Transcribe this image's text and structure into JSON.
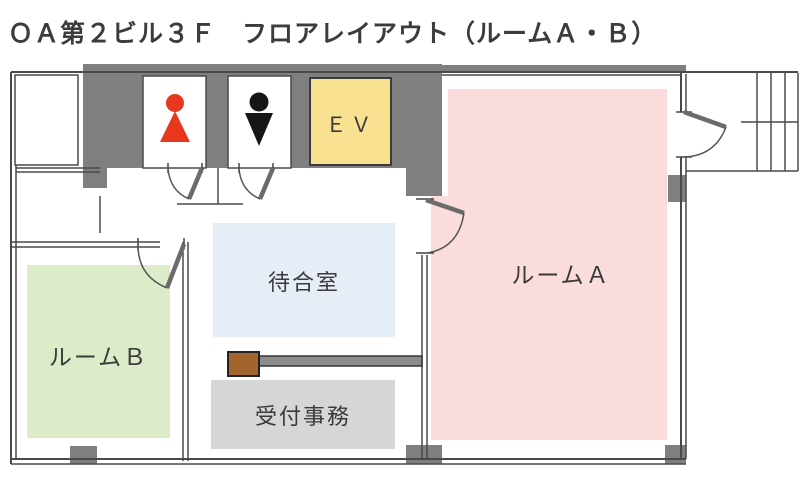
{
  "title": "ＯＡ第２ビル３Ｆ　フロアレイアウト（ルームＡ・Ｂ）",
  "rooms": {
    "room_a": {
      "label": "ルームＡ"
    },
    "room_b": {
      "label": "ルームＢ"
    },
    "waiting_room": {
      "label": "待合室"
    },
    "reception": {
      "label": "受付事務"
    },
    "elevator": {
      "label": "ＥＶ"
    }
  },
  "icons": {
    "female_restroom": "female-figure",
    "male_restroom": "male-figure"
  },
  "colors": {
    "wall_gray": "#7f7f7f",
    "line": "#4a4a4a",
    "leaf": "#6b6b6b",
    "room_a": "#fbdcdc",
    "room_b": "#dcecc9",
    "waiting": "#e5edf6",
    "reception": "#d6d6d6",
    "elevator": "#f8e191",
    "elevator_border": "#3c3c3c",
    "female": "#e8371f",
    "male": "#161616",
    "desk": "#a2662c",
    "counter": "#8c8c8c",
    "text": "#3a3a3a"
  }
}
